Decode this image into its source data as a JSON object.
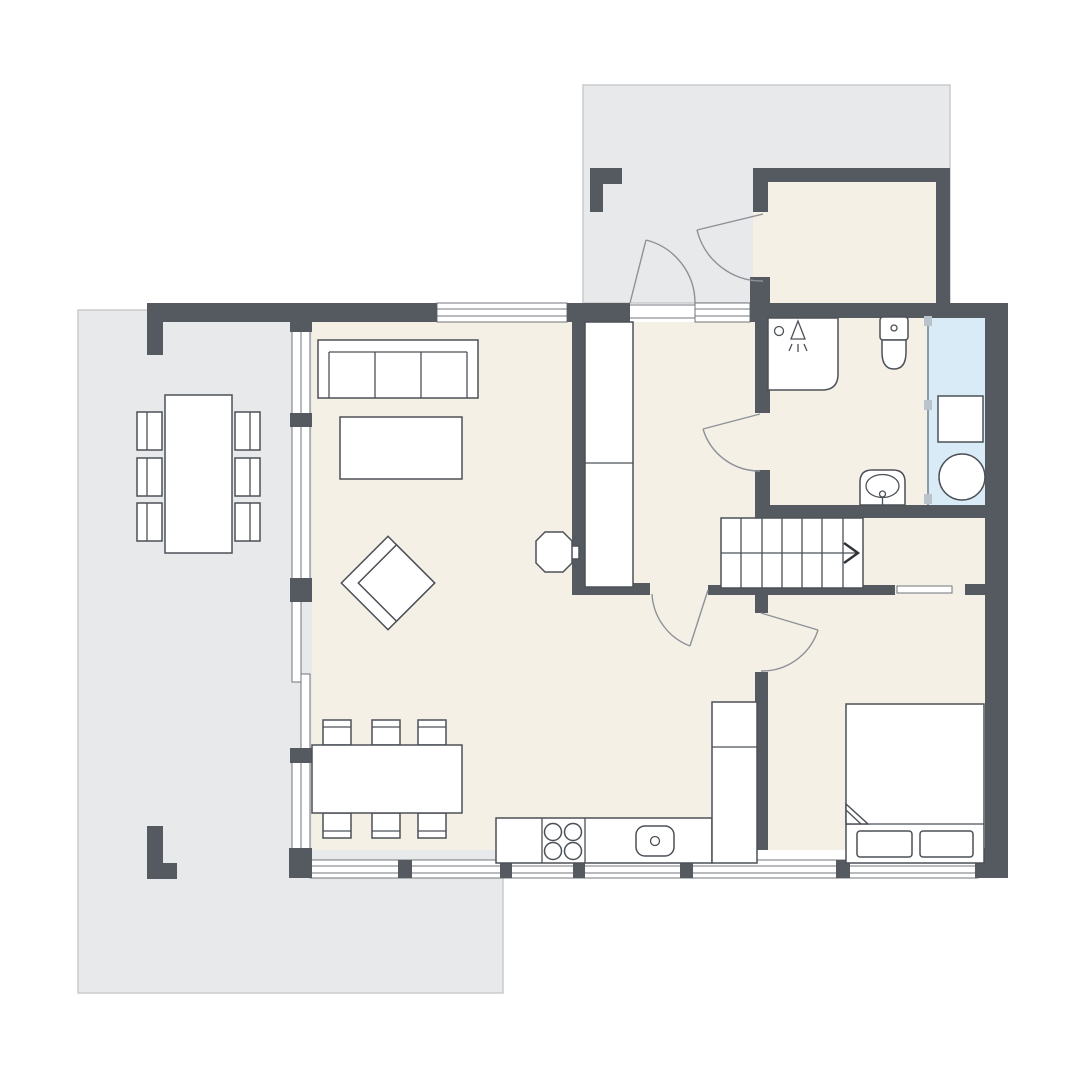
{
  "palette": {
    "background": "#ffffff",
    "wall": "#555a61",
    "floor": "#f5f0e5",
    "terrace": "#e8e9ea",
    "terrace_border": "#c9cbcd",
    "wet_room": "#d9ebf7",
    "furniture_fill": "#ffffff",
    "furniture_stroke": "#4c5157",
    "window_frame": "#70757b",
    "door_arc": "#8d9298",
    "glass_line": "#8a9aa6",
    "glass_knob": "#b9c3cb",
    "arrow": "#2e3338"
  },
  "plan": {
    "type": "floor-plan",
    "canvas": {
      "width": 1080,
      "height": 1080
    },
    "areas": [
      "entrance-terrace",
      "side-terrace",
      "storage-room",
      "bathroom",
      "utility-wet-room",
      "hallway",
      "living-dining-area",
      "kitchen",
      "staircase",
      "bedroom"
    ],
    "symbols": [
      "sofa-3-seat",
      "coffee-table",
      "armchair-rotated",
      "wood-stove",
      "tall-cabinet",
      "dining-table-6-chairs",
      "outdoor-table-6-chairs",
      "kitchen-counter",
      "cooktop-4-burners",
      "kitchen-sink",
      "tall-kitchen-unit",
      "stairs-up-arrow-right",
      "double-bed-2-pillows",
      "shower",
      "toilet",
      "washbasin",
      "washing-machine",
      "round-appliance",
      "door-swing",
      "window"
    ],
    "stairs": {
      "direction": "right",
      "flights": 2,
      "steps_per_flight": 7
    }
  }
}
